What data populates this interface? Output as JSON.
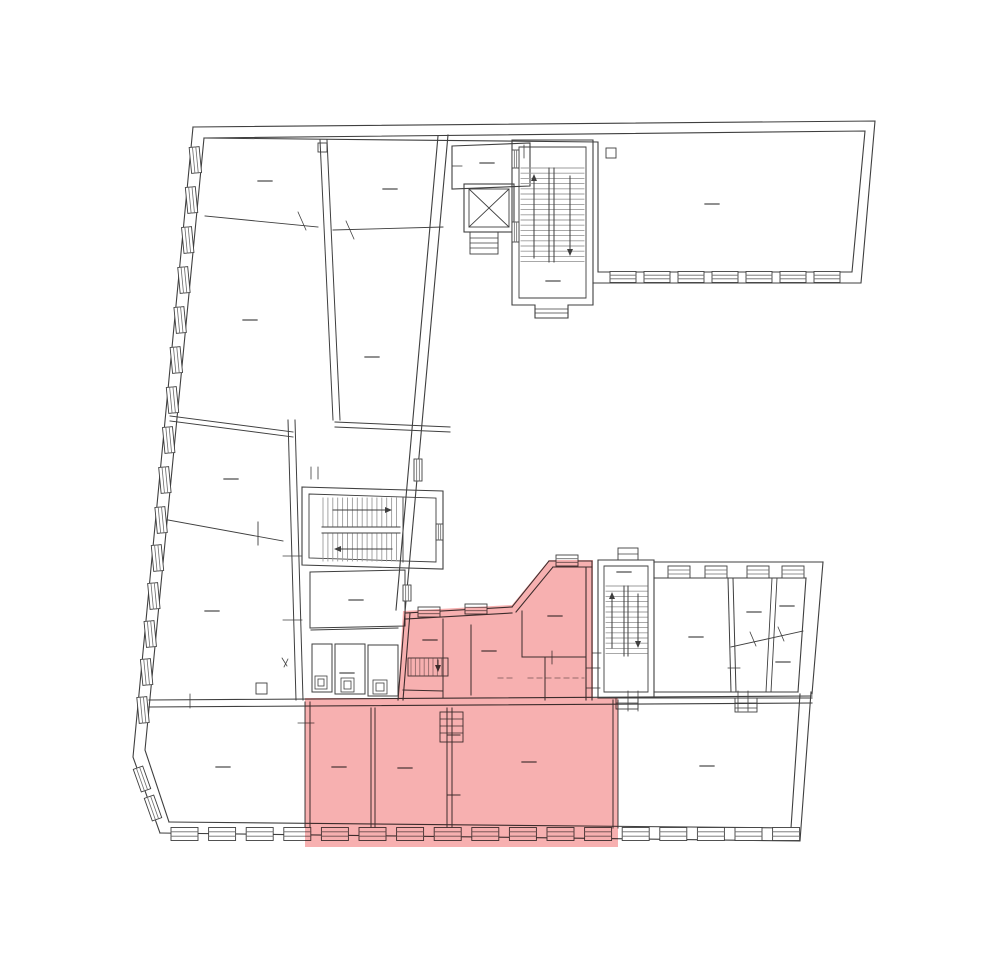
{
  "page": {
    "background": "#ffffff"
  },
  "plan": {
    "ink": "#3f3f3f",
    "thin_ink": "#6b6b6b",
    "tread_gray": "#9b9b9b",
    "dashed_gray": "#9a9a9a",
    "label_dash_color": "#555555",
    "highlight": "#f7b0b0",
    "highlighted_unit_name": "highlighted-apartment-unit",
    "features": {
      "elevator": "elevator-shaft",
      "stairwells": [
        "main-stairwell",
        "courtyard-stairwell",
        "secondary-stairwell",
        "unit-internal-stair"
      ]
    }
  }
}
